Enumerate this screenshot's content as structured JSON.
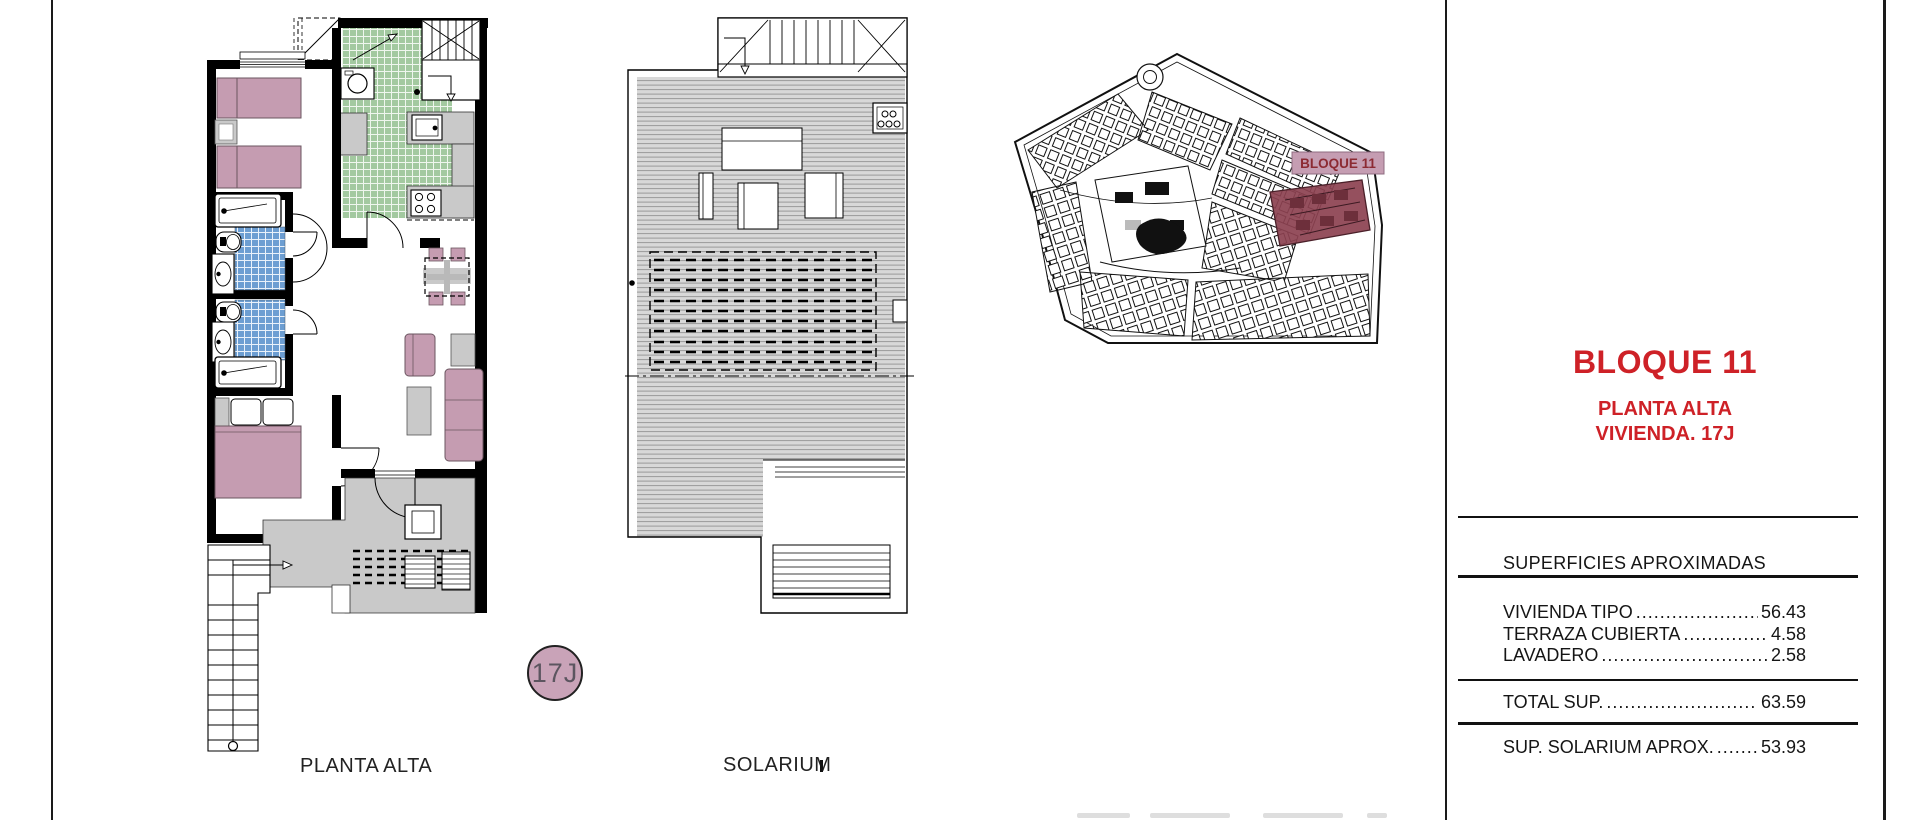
{
  "sheet": {
    "floor_plan_label": "PLANTA ALTA",
    "solarium_label": "SOLARIUM",
    "unit_badge": "17J"
  },
  "site_map": {
    "block_label": "BLOQUE 11",
    "highlight_color": "#8c4150",
    "label_bg_color": "#c59db2"
  },
  "title_block": {
    "accent_color": "#ce2127",
    "block_title": "BLOQUE 11",
    "floor_line": "PLANTA ALTA",
    "unit_line": "VIVIENDA. 17J",
    "surfaces_header": "SUPERFICIES APROXIMADAS",
    "surface_rows": [
      {
        "label": "VIVIENDA TIPO",
        "leader": "......................................",
        "value": "56.43"
      },
      {
        "label": "TERRAZA CUBIERTA",
        "leader": "......................................",
        "value": "4.58"
      },
      {
        "label": "LAVADERO",
        "leader": "......................................",
        "value": "2.58"
      }
    ],
    "total_row": {
      "label": "TOTAL SUP.",
      "leader": "......................................",
      "value": "63.59"
    },
    "solarium_row": {
      "label": "SUP. SOLARIUM APROX.",
      "leader": "......................................",
      "value": "53.93"
    }
  }
}
